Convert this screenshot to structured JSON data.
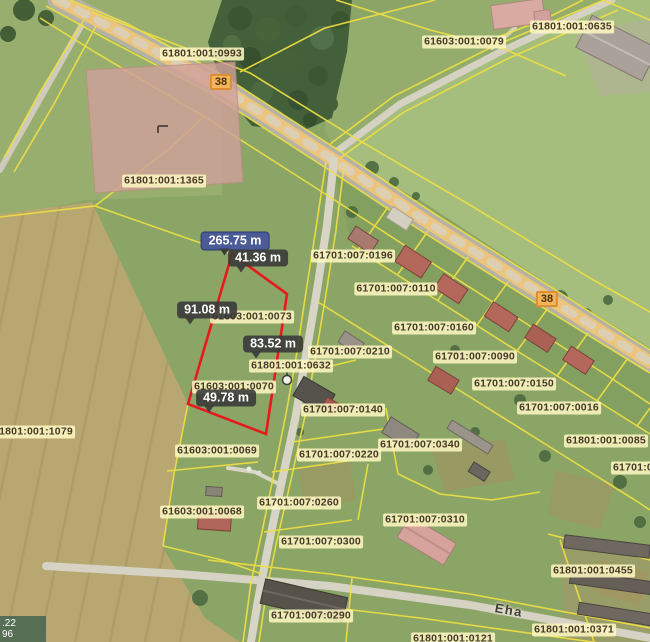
{
  "measurements": {
    "total": "265.75 m",
    "seg1": "41.36 m",
    "seg2": "91.08 m",
    "seg3": "83.52 m",
    "seg4": "49.78 m"
  },
  "parcels": [
    "61801:001:0993",
    "61603:001:0079",
    "61801:001:0635",
    "61801:001:1365",
    "61701:007:0196",
    "61701:007:0110",
    "61701:007:0160",
    "61701:007:0210",
    "61701:007:0090",
    "61701:007:0150",
    "61701:007:0016",
    "61801:001:0085",
    "61701:00",
    "61701:007:0140",
    "61603:001:0073",
    "61801:001:0632",
    "61603:001:0070",
    "61801:001:1079",
    "61603:001:0069",
    "61603:001:0068",
    "61701:007:0260",
    "61701:007:0220",
    "61701:007:0340",
    "61701:007:0310",
    "61701:007:0300",
    "61701:007:0290",
    "61801:001:0455",
    "61801:001:0371",
    "61801:001:0121"
  ],
  "roads": {
    "marker1": "38",
    "marker2": "38",
    "street": "Eha"
  },
  "overlay": {
    "line1": ".22",
    "line2": "96"
  },
  "colors": {
    "parcel_line": "#efdf42",
    "measure_red": "#e8191c",
    "label_bg": "#fdf7c1",
    "measure_box": "#3a3a3a",
    "total_box": "#4b5b97",
    "road_marker_bg": "#f2b55e",
    "highlight_parcel_fill": "#d0a19a"
  }
}
